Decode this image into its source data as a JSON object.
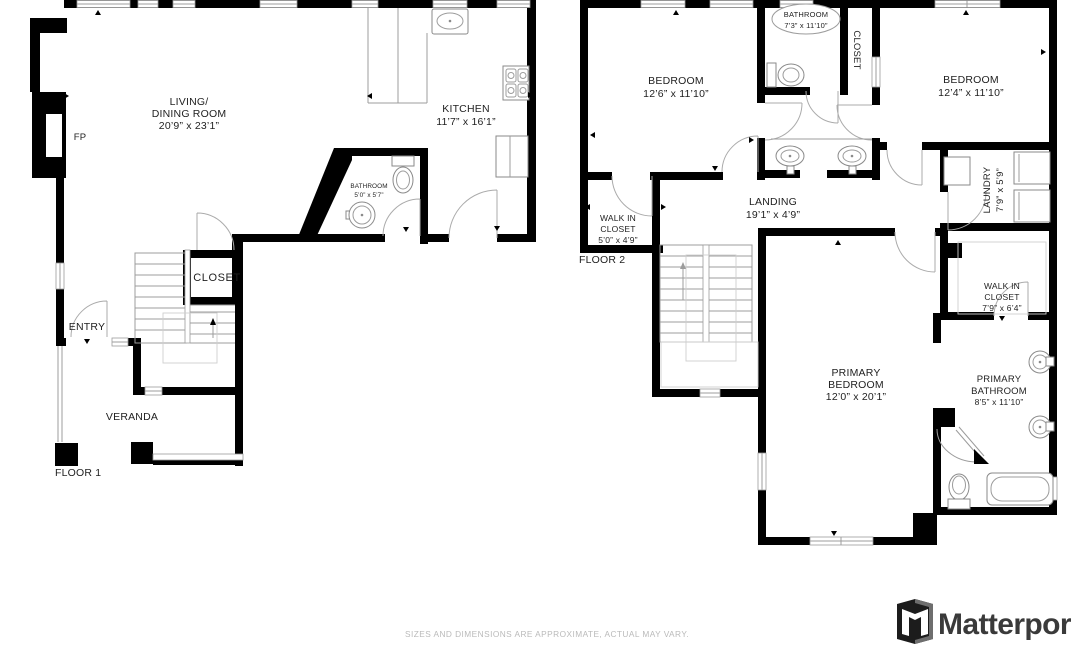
{
  "page": {
    "disclaimer": "SIZES AND DIMENSIONS ARE APPROXIMATE, ACTUAL MAY VARY.",
    "brand": "Matterport"
  },
  "colors": {
    "wall": "#000000",
    "background": "#ffffff",
    "fixture_outline": "#8a8a8a",
    "light_outline": "#cfcfcf",
    "label_text": "#1f1f1f",
    "disclaimer_text": "#bababa",
    "brand_text": "#3a3a3a"
  },
  "floor1": {
    "label": "FLOOR 1",
    "rooms": {
      "living": {
        "lines": [
          "LIVING/",
          "DINING ROOM",
          "20’9” x 23’1”"
        ]
      },
      "kitchen": {
        "lines": [
          "KITCHEN",
          "11’7” x 16’1”"
        ]
      },
      "bathroom": {
        "lines": [
          "BATHROOM",
          "5’0” x 5’7”"
        ]
      },
      "closet": {
        "lines": [
          "CLOSET"
        ]
      },
      "entry": {
        "lines": [
          "ENTRY"
        ]
      },
      "veranda": {
        "lines": [
          "VERANDA"
        ]
      },
      "fireplace": {
        "lines": [
          "FP"
        ]
      }
    }
  },
  "floor2": {
    "label": "FLOOR 2",
    "rooms": {
      "bedroom_left": {
        "lines": [
          "BEDROOM",
          "12’6” x 11’10”"
        ]
      },
      "bathroom": {
        "lines": [
          "BATHROOM",
          "7’3” x 11’10”"
        ]
      },
      "closet": {
        "lines": [
          "CLOSET"
        ]
      },
      "bedroom_right": {
        "lines": [
          "BEDROOM",
          "12’4” x 11’10”"
        ]
      },
      "walk_in_closet_left": {
        "lines": [
          "WALK IN",
          "CLOSET",
          "5’0” x 4’9”"
        ]
      },
      "landing": {
        "lines": [
          "LANDING",
          "19’1” x 4’9”"
        ]
      },
      "laundry": {
        "lines": [
          "LAUNDRY",
          "7’9” x 5’9”"
        ]
      },
      "primary_bedroom": {
        "lines": [
          "PRIMARY",
          "BEDROOM",
          "12’0” x 20’1”"
        ]
      },
      "walk_in_closet_right": {
        "lines": [
          "WALK IN",
          "CLOSET",
          "7’9” x 6’4”"
        ]
      },
      "primary_bathroom": {
        "lines": [
          "PRIMARY",
          "BATHROOM",
          "8’5” x 11’10”"
        ]
      }
    }
  }
}
